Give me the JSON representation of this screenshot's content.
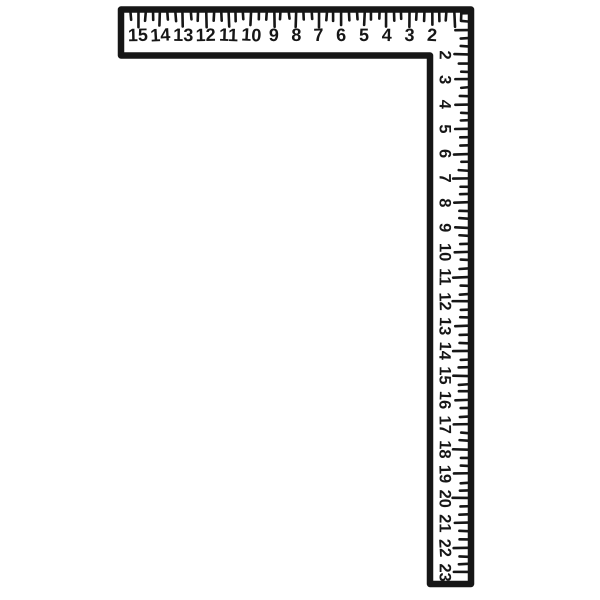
{
  "illustration": {
    "name": "carpenter-framing-square",
    "background_color": "#ffffff",
    "ink_color": "#161616",
    "horizontal_scale": {
      "numbers": [
        "15",
        "14",
        "13",
        "12",
        "11",
        "10",
        "9",
        "8",
        "7",
        "6",
        "5",
        "4",
        "3",
        "2"
      ]
    },
    "vertical_scale": {
      "numbers": [
        "2",
        "3",
        "4",
        "5",
        "6",
        "7",
        "8",
        "9",
        "10",
        "11",
        "12",
        "13",
        "14",
        "15",
        "16",
        "17",
        "18",
        "19",
        "20",
        "21",
        "22",
        "23"
      ]
    }
  }
}
